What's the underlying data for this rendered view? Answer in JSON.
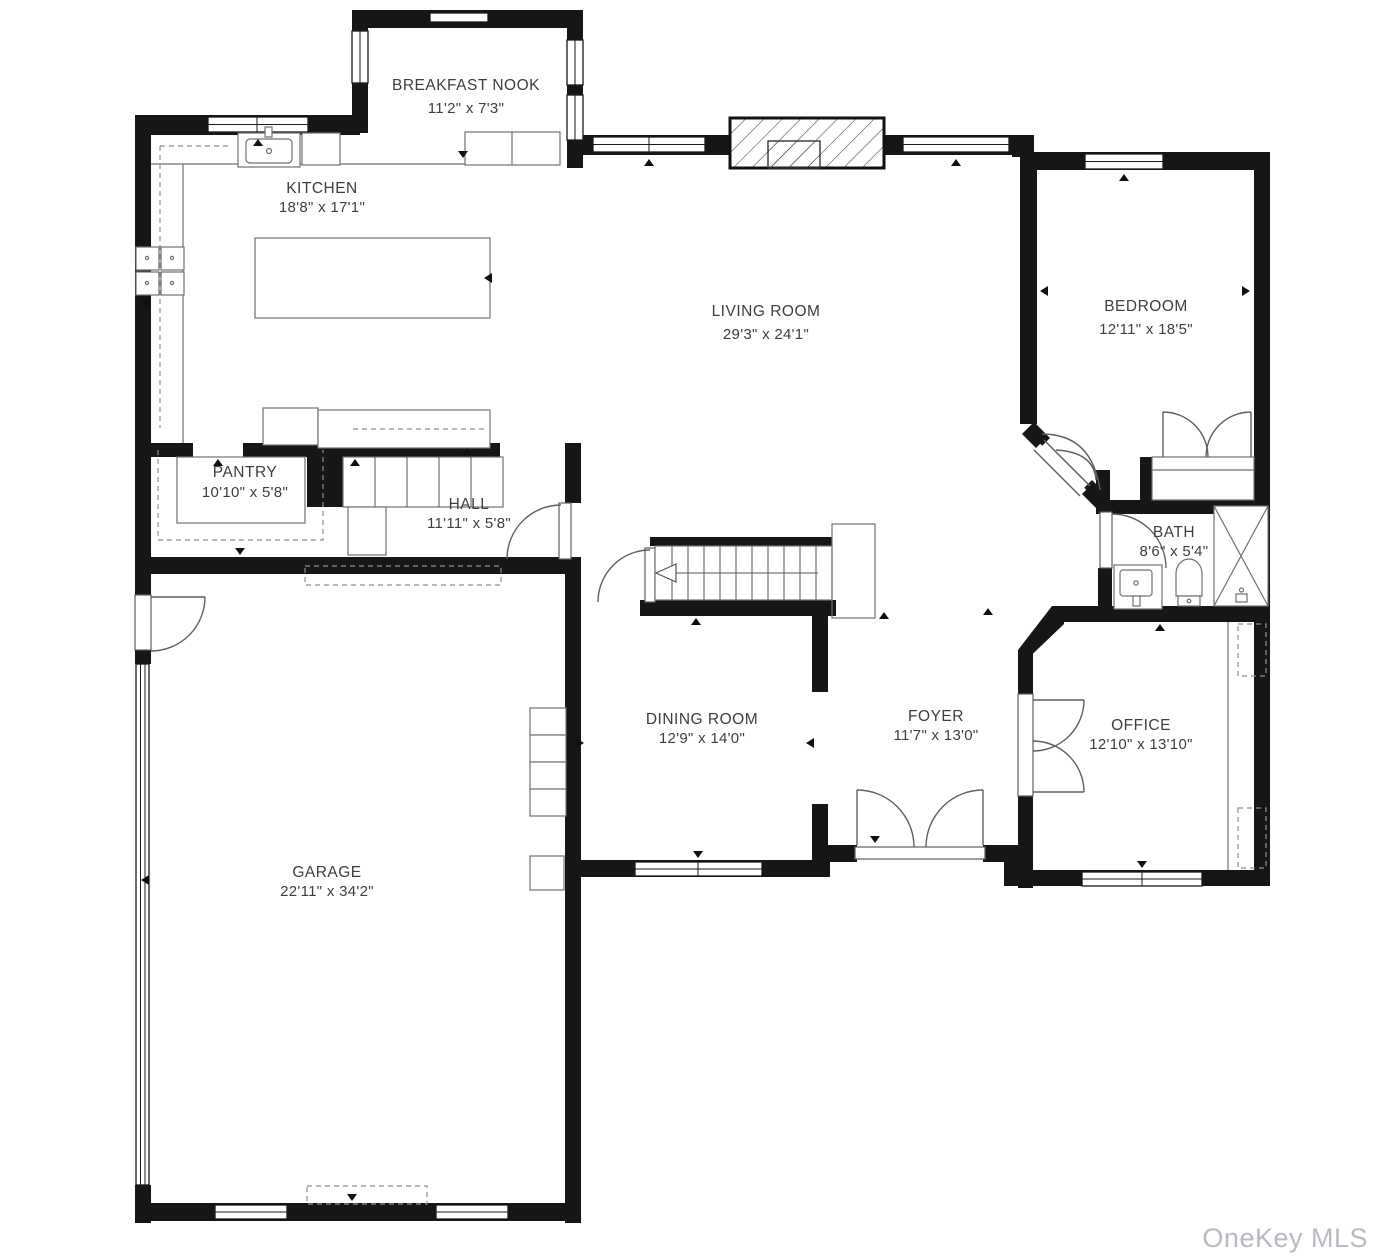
{
  "watermark": "OneKey MLS",
  "colors": {
    "wall": "#161616",
    "label": "#3e3e3e",
    "watermark": "#b7bac0",
    "fixture": "#707070"
  },
  "rooms": {
    "breakfast_nook": {
      "name": "BREAKFAST NOOK",
      "dims": "11'2\" x 7'3\""
    },
    "kitchen": {
      "name": "KITCHEN",
      "dims": "18'8\" x 17'1\""
    },
    "living_room": {
      "name": "LIVING ROOM",
      "dims": "29'3\" x 24'1\""
    },
    "bedroom": {
      "name": "BEDROOM",
      "dims": "12'11\" x 18'5\""
    },
    "pantry": {
      "name": "PANTRY",
      "dims": "10'10\" x 5'8\""
    },
    "hall": {
      "name": "HALL",
      "dims": "11'11\" x 5'8\""
    },
    "bath": {
      "name": "BATH",
      "dims": "8'6\" x 5'4\""
    },
    "dining_room": {
      "name": "DINING ROOM",
      "dims": "12'9\" x 14'0\""
    },
    "foyer": {
      "name": "FOYER",
      "dims": "11'7\" x 13'0\""
    },
    "office": {
      "name": "OFFICE",
      "dims": "12'10\" x 13'10\""
    },
    "garage": {
      "name": "GARAGE",
      "dims": "22'11\" x 34'2\""
    }
  }
}
